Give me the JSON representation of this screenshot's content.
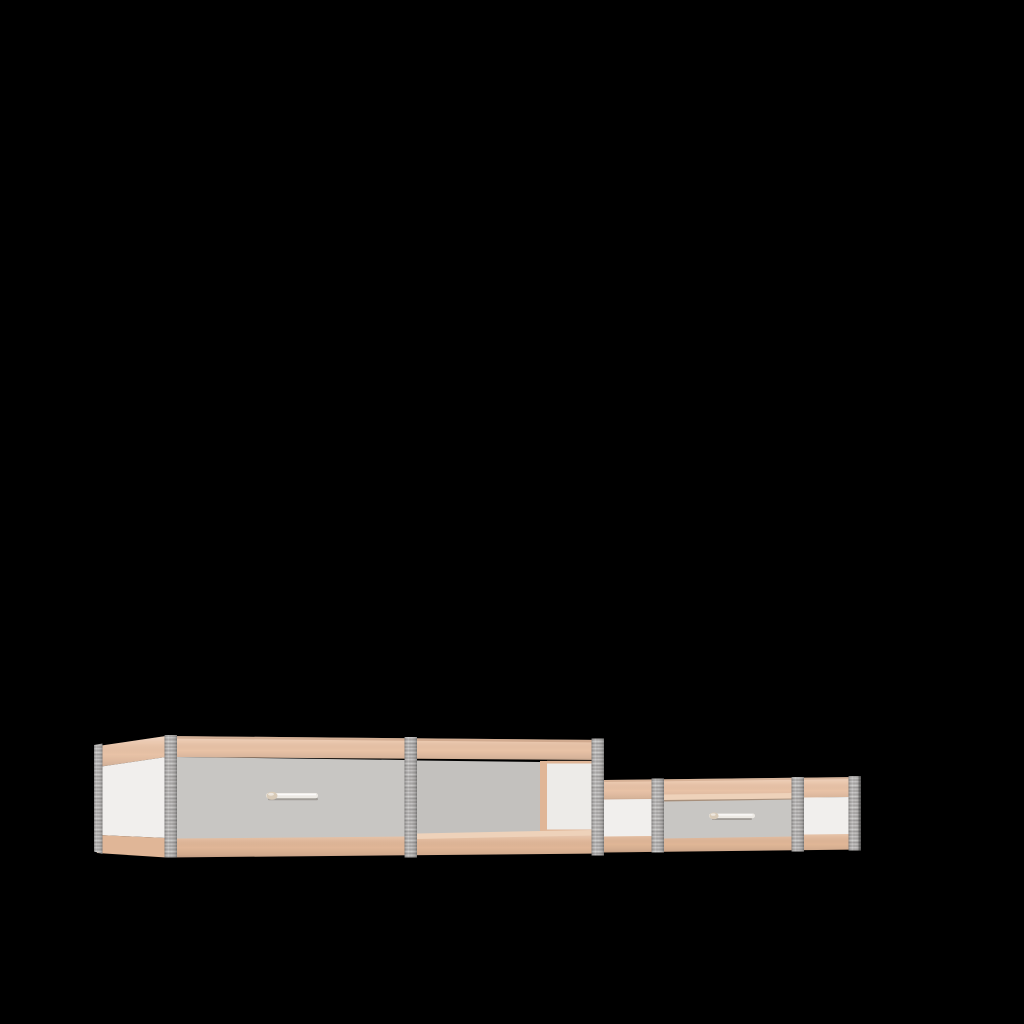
{
  "scene": {
    "background_color": "#000000",
    "object": "sideboard-3d-render"
  },
  "colors": {
    "background": "#000000",
    "wood": "#e8c2a6",
    "wood_light": "#eed2ba",
    "wood_dark": "#e0b697",
    "panel_gray": "#c8c6c3",
    "panel_gray_dark": "#c3c1be",
    "panel_white": "#f1efed",
    "panel_white_dim": "#edebe8",
    "metal": "#b6b4b3",
    "handle_bar": "#edeae5",
    "handle_cap": "#d9cbb8"
  },
  "furniture": {
    "name": "low-sideboard",
    "drawer_count": 2,
    "handle_count": 2,
    "metal_post_count": 7,
    "units": [
      {
        "name": "tall-unit",
        "parts": [
          "left-side-face",
          "top-rail",
          "large-drawer",
          "large-drawer-handle",
          "open-compartment",
          "bottom-rail"
        ]
      },
      {
        "name": "low-unit",
        "parts": [
          "top-rail",
          "white-panel-left",
          "small-drawer",
          "small-drawer-handle",
          "white-panel-right",
          "bottom-rail"
        ]
      }
    ]
  }
}
